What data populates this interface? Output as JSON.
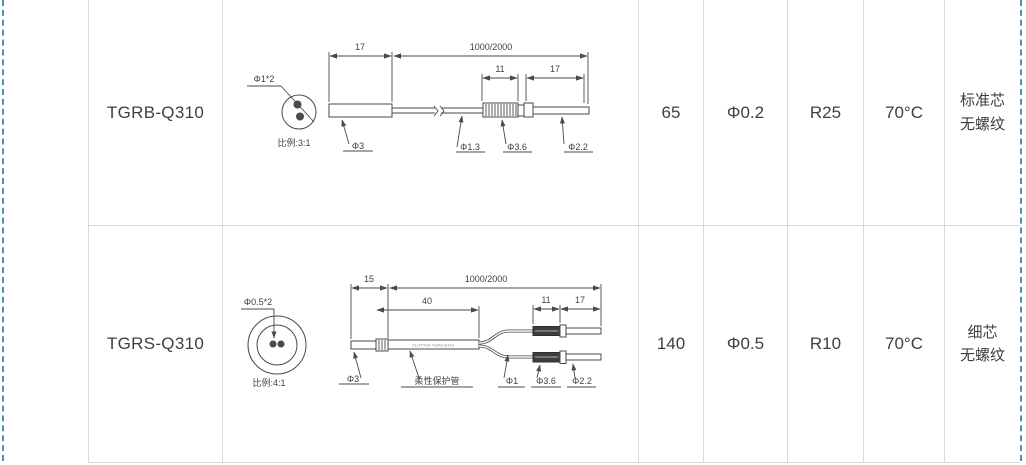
{
  "table": {
    "rows": [
      {
        "model": "TGRB-Q310",
        "values": [
          "65",
          "Φ0.2",
          "R25",
          "70°C"
        ],
        "spec": [
          "标准芯",
          "无螺纹"
        ]
      },
      {
        "model": "TGRS-Q310",
        "values": [
          "140",
          "Φ0.5",
          "R10",
          "70°C"
        ],
        "spec": [
          "细芯",
          "无螺纹"
        ]
      }
    ]
  },
  "diagrams": {
    "tgrb": {
      "cross_section_label": "Φ1*2",
      "scale_caption": "比例:3:1",
      "dims": {
        "head": "17",
        "cable": "1000/2000",
        "knurl": "11",
        "tip": "17"
      },
      "labels": {
        "body": "Φ3",
        "cable": "Φ1.3",
        "knurl": "Φ3.6",
        "tip": "Φ2.2"
      }
    },
    "tgrs": {
      "cross_section_label": "Φ0.5*2",
      "scale_caption": "比例:4:1",
      "tube_print": "CLOTTER TGRS-Q310",
      "dims": {
        "head": "15",
        "cable": "1000/2000",
        "tube": "40",
        "knurl": "11",
        "tip": "17"
      },
      "labels": {
        "body": "Φ3",
        "tube": "柔性保护管",
        "cable": "Φ1",
        "knurl": "Φ3.6",
        "tip": "Φ2.2"
      }
    }
  }
}
